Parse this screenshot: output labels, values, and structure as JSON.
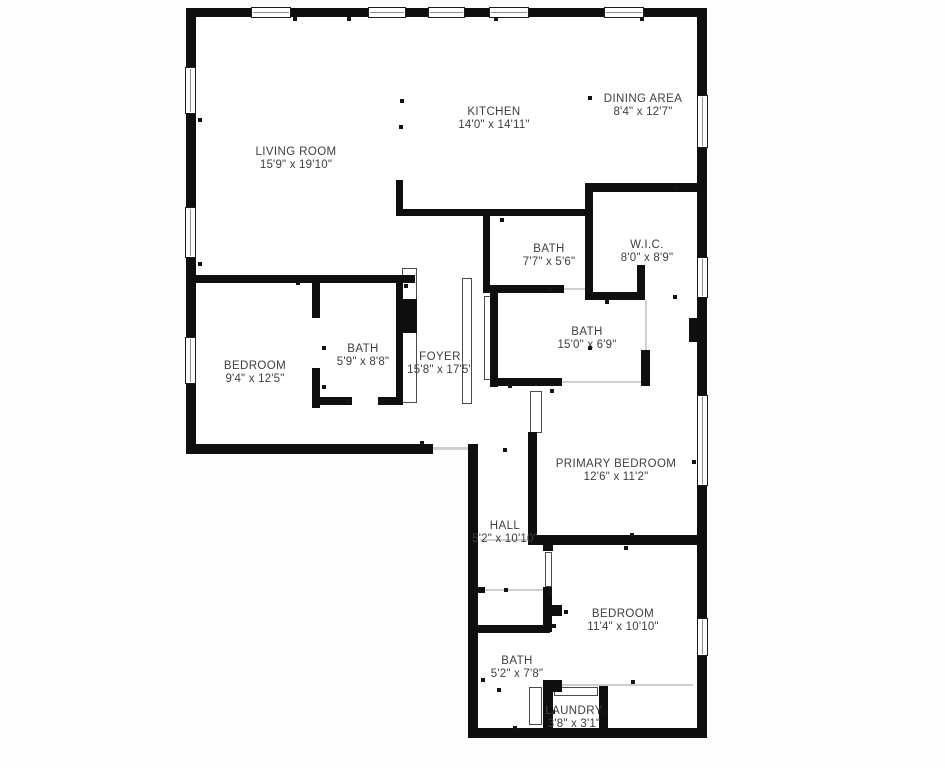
{
  "page": {
    "type": "floor-plan",
    "wall_color": "#0f0f0f",
    "floor_color": "#ffffff",
    "text_color": "#3e3e3e"
  },
  "floorplan": {
    "rooms": [
      {
        "name": "LIVING ROOM",
        "dims": "15'9\" x 19'10\""
      },
      {
        "name": "KITCHEN",
        "dims": "14'0\" x 14'11\""
      },
      {
        "name": "DINING AREA",
        "dims": "8'4\" x 12'7\""
      },
      {
        "name": "BATH",
        "dims": "7'7\" x 5'6\""
      },
      {
        "name": "W.I.C.",
        "dims": "8'0\" x 8'9\""
      },
      {
        "name": "BATH",
        "dims": "15'0\" x 6'9\""
      },
      {
        "name": "BEDROOM",
        "dims": "9'4\" x 12'5\""
      },
      {
        "name": "BATH",
        "dims": "5'9\" x 8'8\""
      },
      {
        "name": "FOYER",
        "dims": "15'8\" x 17'5\""
      },
      {
        "name": "PRIMARY BEDROOM",
        "dims": "12'6\" x 11'2\""
      },
      {
        "name": "HALL",
        "dims": "5'2\" x 10'10\""
      },
      {
        "name": "BEDROOM",
        "dims": "11'4\" x 10'10\""
      },
      {
        "name": "BATH",
        "dims": "5'2\" x 7'8\""
      },
      {
        "name": "LAUNDRY",
        "dims": "3'8\" x 3'1\""
      }
    ]
  }
}
